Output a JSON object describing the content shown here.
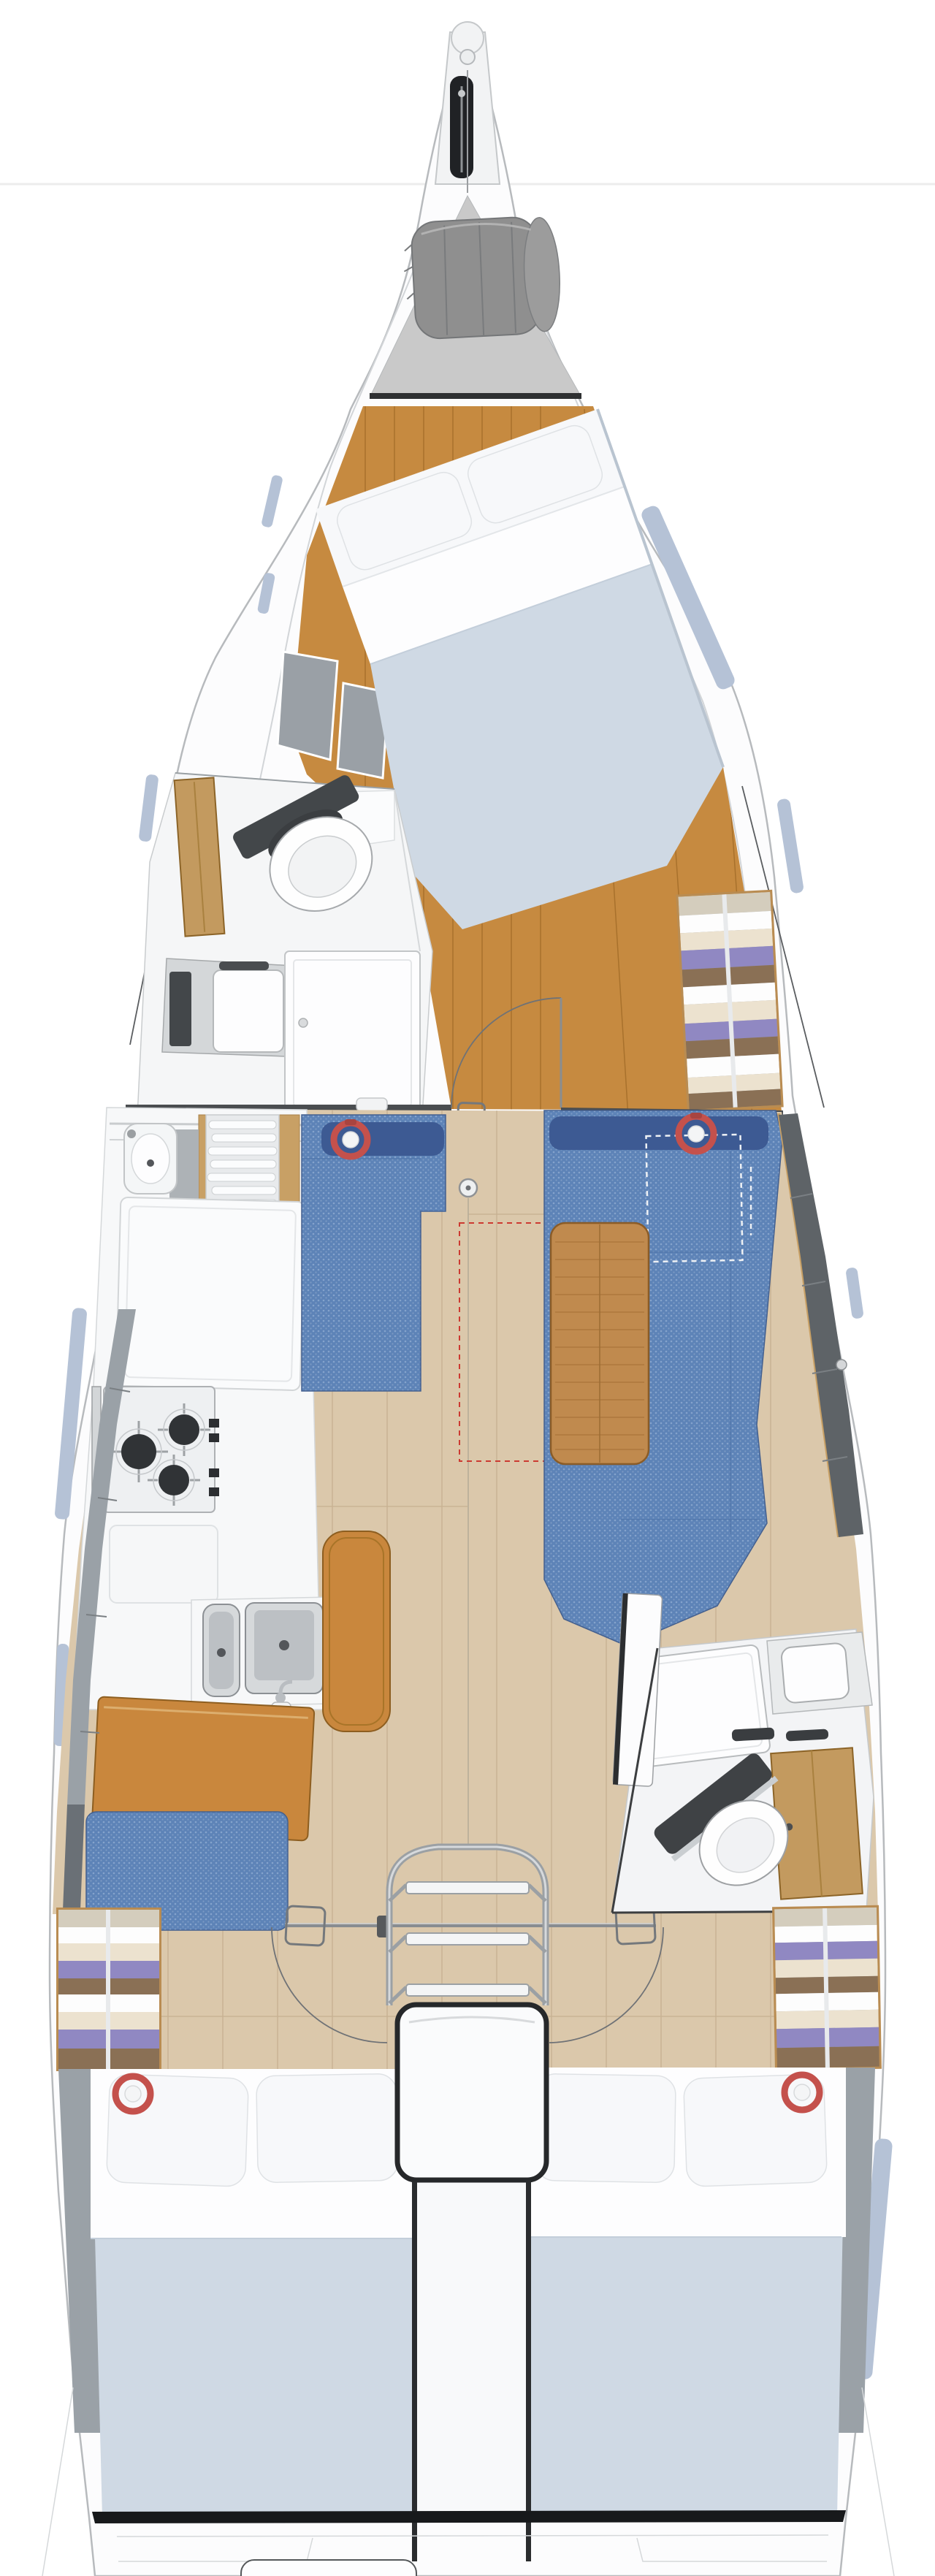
{
  "palette": {
    "background": "#ffffff",
    "hull_fill": "#fcfcfd",
    "hull_stroke": "#b7babd",
    "inner_line": "#d2d5d8",
    "horizon": "#ececec",
    "locker_gray": "#c9c9c9",
    "bag_gray": "#8f8f8f",
    "dark": "#202225",
    "fwd_wood": "#c68a40",
    "fwd_wood_line": "#a8712c",
    "floor_wood": "#dbc8ab",
    "floor_line": "#c6b091",
    "mattress": "#cfd9e4",
    "pillow": "#f7f8fa",
    "sheet": "#fdfdfe",
    "shelf_gray": "#9aa0a6",
    "sofa_blue": "#5d83b7",
    "sofa_navy": "#3d5a93",
    "wood_trim": "#c8a065",
    "table_wood": "#c08a4e",
    "leather": "#c9873d",
    "counter_white": "#f7f8f9",
    "steel": "#d4d7d9",
    "burner": "#303336",
    "deck_gray": "#9aa1a7",
    "deck_dark": "#6a7076",
    "cushion_gray": "#5e6367",
    "window_blue": "#b5c2d6",
    "red": "#c4514c",
    "red_dash": "#cc3a31",
    "white_dash": "#eef1f5",
    "chrome": "#b9bdc1",
    "chrome_dark": "#83878b",
    "head_white": "#f5f6f7",
    "wood_locker": "#c39a5f",
    "wardrobe_frame": "#b98c52"
  },
  "icons": {
    "red_ring": "round red ring marker on upholstery",
    "mast_post": "circle with center dot",
    "anchor_slot": "dark bow roller slot with anchor shank",
    "mast_bag": "gray rolled sail bag in bow locker"
  },
  "fixtures": {
    "red_ring_markers": 4,
    "stove_burners": 3,
    "galley_sinks": 2,
    "heads": 2,
    "berths": 3,
    "companionway_steps": 3,
    "wardrobes": 3
  }
}
